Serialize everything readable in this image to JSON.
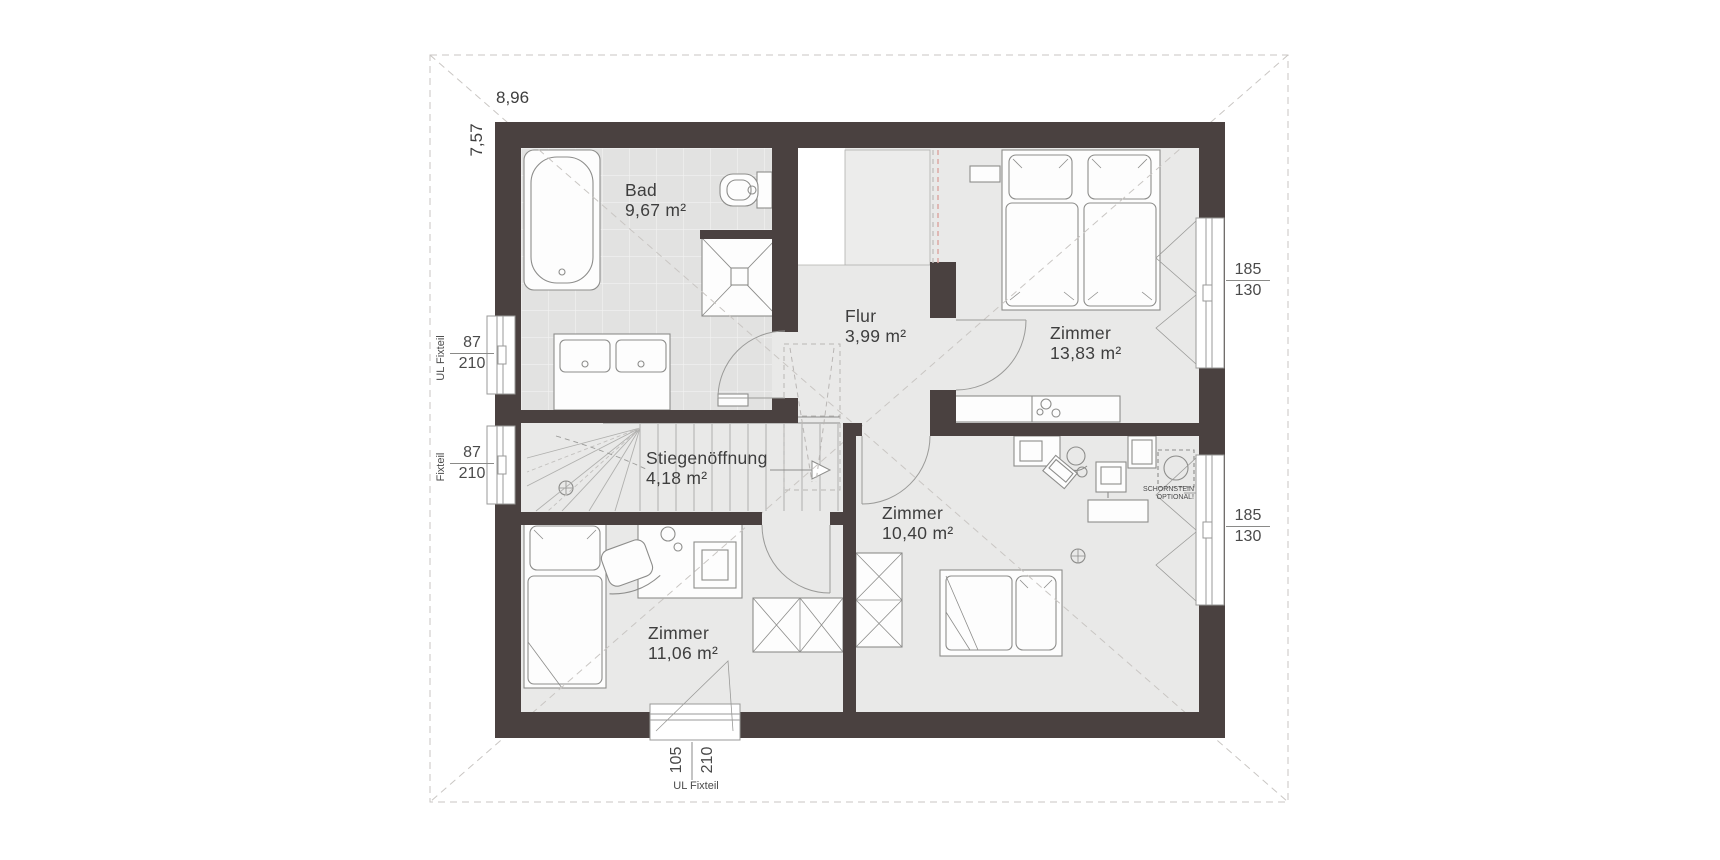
{
  "plan": {
    "dimensions": {
      "width": "8,96",
      "height": "7,57"
    },
    "rooms": [
      {
        "name": "Bad",
        "area": "9,67 m²"
      },
      {
        "name": "Flur",
        "area": "3,99 m²"
      },
      {
        "name": "Zimmer",
        "area": "13,83 m²"
      },
      {
        "name": "Stiegenöffnung",
        "area": "4,18 m²"
      },
      {
        "name": "Zimmer",
        "area": "11,06 m²"
      },
      {
        "name": "Zimmer",
        "area": "10,40 m²"
      }
    ],
    "windows": {
      "left_top": {
        "type": "UL Fixteil",
        "width": "87",
        "height": "210"
      },
      "left_bottom": {
        "type": "Fixteil",
        "width": "87",
        "height": "210"
      },
      "right_top": {
        "width": "185",
        "height": "130"
      },
      "right_bottom": {
        "width": "185",
        "height": "130"
      },
      "bottom": {
        "type": "UL Fixteil",
        "width": "105",
        "height": "210"
      }
    },
    "annotations": {
      "chimney_line1": "SCHORNSTEIN",
      "chimney_line2": "OPTIONAL!"
    },
    "colors": {
      "wall": "#4a4140",
      "floor": "#e9e9e8",
      "tile": "#e2e2e1",
      "roof_dash": "#c9c6c3",
      "section_dash": "#dba49e"
    }
  }
}
